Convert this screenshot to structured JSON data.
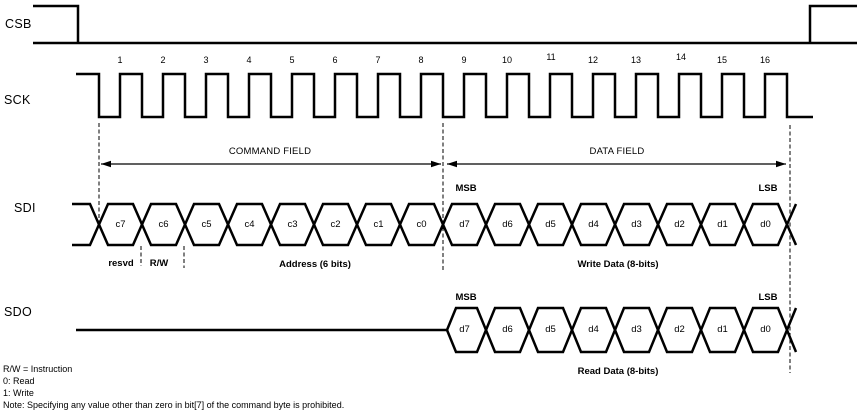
{
  "diagram": {
    "title": "SPI read/write timing diagram",
    "signals": {
      "csb": "CSB",
      "sck": "SCK",
      "sdi": "SDI",
      "sdo": "SDO"
    },
    "sck": {
      "cycle_numbers": [
        "1",
        "2",
        "3",
        "4",
        "5",
        "6",
        "7",
        "8",
        "9",
        "10",
        "11",
        "12",
        "13",
        "14",
        "15",
        "16"
      ]
    },
    "fields": {
      "command_label": "COMMAND FIELD",
      "data_label": "DATA FIELD"
    },
    "sdi": {
      "cells": [
        "c7",
        "c6",
        "c5",
        "c4",
        "c3",
        "c2",
        "c1",
        "c0",
        "d7",
        "d6",
        "d5",
        "d4",
        "d3",
        "d2",
        "d1",
        "d0"
      ],
      "msb_label": "MSB",
      "lsb_label": "LSB",
      "resvd_label": "resvd",
      "rw_label": "R/W",
      "address_label": "Address (6 bits)",
      "write_label": "Write Data (8-bits)"
    },
    "sdo": {
      "cells": [
        "d7",
        "d6",
        "d5",
        "d4",
        "d3",
        "d2",
        "d1",
        "d0"
      ],
      "msb_label": "MSB",
      "lsb_label": "LSB",
      "read_label": "Read Data (8-bits)"
    },
    "notes": [
      "R/W = Instruction",
      "0: Read",
      "1: Write",
      "Note: Specifying any value other than zero in bit[7] of the command byte is prohibited."
    ],
    "colors": {
      "line": "#000000",
      "text": "#000000",
      "background": "#ffffff"
    }
  }
}
